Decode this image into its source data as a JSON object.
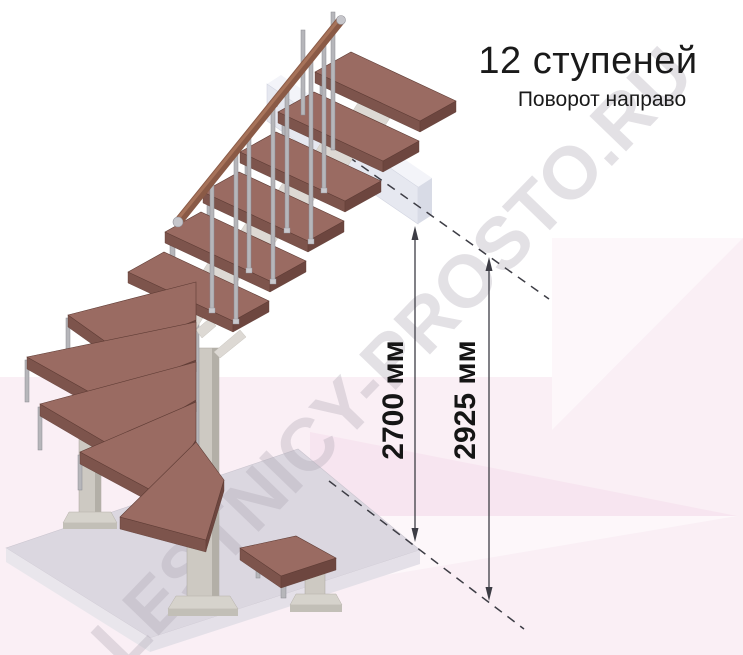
{
  "header": {
    "title": "12 ступеней",
    "subtitle": "Поворот направо"
  },
  "watermark": {
    "text": "LESTNICY-PROSTO.RU"
  },
  "dimensions": {
    "floor_height": {
      "label": "2700 мм",
      "value": 2700,
      "unit": "мм"
    },
    "total_height": {
      "label": "2925 мм",
      "value": 2925,
      "unit": "мм"
    }
  },
  "diagram": {
    "type": "staircase-3d-isometric",
    "steps_count": 12,
    "turn_direction": "right",
    "straight_flight_steps": 6,
    "winder_steps": 5,
    "bottom_steps": 1
  },
  "colors": {
    "text": "#1a1a1a",
    "background_pink": "#faeff5",
    "tread": "#9a6b62",
    "tread_front": "#7d544c",
    "tread_end": "#6d463f",
    "handrail": "#8a5a46",
    "handrail_highlight": "#a7735a",
    "metal": "#b6b6ba",
    "column": "#cdc9c2",
    "floor_top": "#dbd7e0",
    "upper_slab": "#e6e8f0",
    "dimension_line": "#3d3d45",
    "watermark": "rgba(174,167,178,0.34)"
  }
}
